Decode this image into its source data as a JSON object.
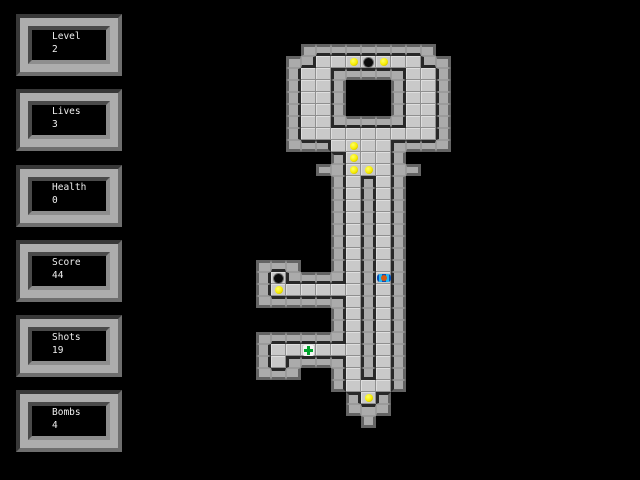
{
  "app": {
    "background": "#000000"
  },
  "stats_panels": [
    {
      "id": "level",
      "label": "Level",
      "value": "2"
    },
    {
      "id": "lives",
      "label": "Lives",
      "value": "3"
    },
    {
      "id": "health",
      "label": "Health",
      "value": "0"
    },
    {
      "id": "score",
      "label": "Score",
      "value": "44"
    },
    {
      "id": "shots",
      "label": "Shots",
      "value": "19"
    },
    {
      "id": "bombs",
      "label": "Bombs",
      "value": "4"
    }
  ],
  "maze": {
    "description": "Key-shaped dungeon level built from beveled stone blocks",
    "legend": {
      "#": "wall-block",
      "F": "floor-tile",
      "Y": "floor-tile with yellow gem",
      "O": "floor-tile with black hole item",
      "C": "floor-tile with green health cross",
      "P": "floor-tile with player sprite",
      "H": "keyhole opening (black)",
      ".": "empty blackness"
    },
    "tile": {
      "width": 15,
      "height": 12
    },
    "origin": {
      "x": 256,
      "y": 44
    },
    "grid": [
      "...#########.",
      "..##FFYOYFF##",
      "..#FF#####FF#",
      "..#FF#HHH#FF#",
      "..#FF#HHH#FF#",
      "..#FF#HHH#FF#",
      "..#FF#####FF#",
      "..#FFFFFFFFF#",
      "..###FYFF####",
      ".....#YFF#...",
      "....##YYF##..",
      ".....#F#F#...",
      ".....#F#F#...",
      ".....#F#F#...",
      ".....#F#F#...",
      ".....#F#F#...",
      ".....#F#F#...",
      ".....#F#F#...",
      "###..#F#F#...",
      "#O####F#P#...",
      "#YFFFFF#F#...",
      "######F#F#...",
      ".....#F#F#...",
      ".....#F#F#...",
      "######F#F#...",
      "#FFCFFF#F#...",
      "#F####F#F#...",
      "###..#F#F#...",
      ".....#FFF#...",
      "......#Y#....",
      "......###....",
      ".......#....."
    ],
    "item_counts": {
      "gems": 8,
      "hole_items": 2,
      "health_kits": 1
    },
    "player": {
      "col": 8,
      "row": 19
    },
    "colors": {
      "wall_face": "#ABABAB",
      "wall_dark_edge": "#282828",
      "wall_outer_edge": "#646464",
      "wall_seam": "#9B9B9B",
      "floor": "#C9C9C9",
      "gem": "#F6EC00",
      "health_green": "#00A42C",
      "player_blue": "#22B8F4",
      "player_orange": "#D85A10",
      "background": "#000000"
    }
  }
}
